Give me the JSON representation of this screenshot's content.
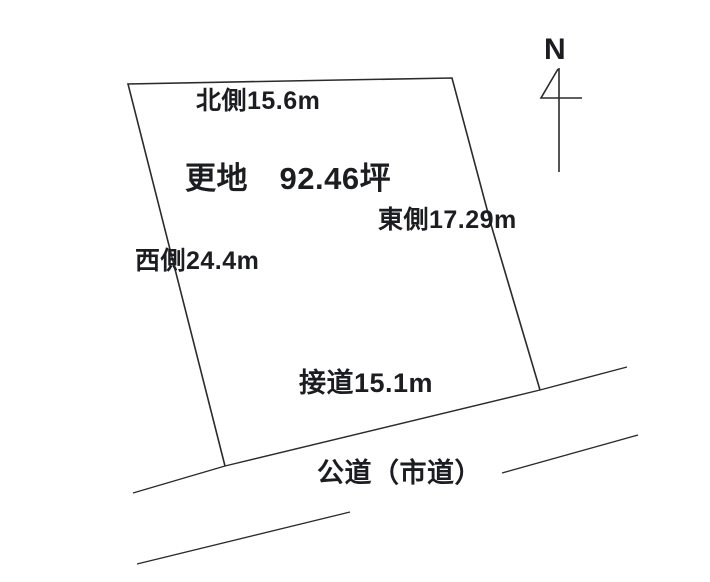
{
  "diagram": {
    "title_none": "",
    "compass": {
      "label": "N"
    },
    "plot": {
      "land_label": "更地　92.46坪",
      "north_side": "北側15.6m",
      "east_side": "東側17.29m",
      "west_side": "西側24.4m",
      "frontage": "接道15.1m"
    },
    "road": {
      "label": "公道（市道）"
    },
    "colors": {
      "line": "#2b2b2b",
      "text": "#1c1d21",
      "background": "#ffffff"
    }
  }
}
